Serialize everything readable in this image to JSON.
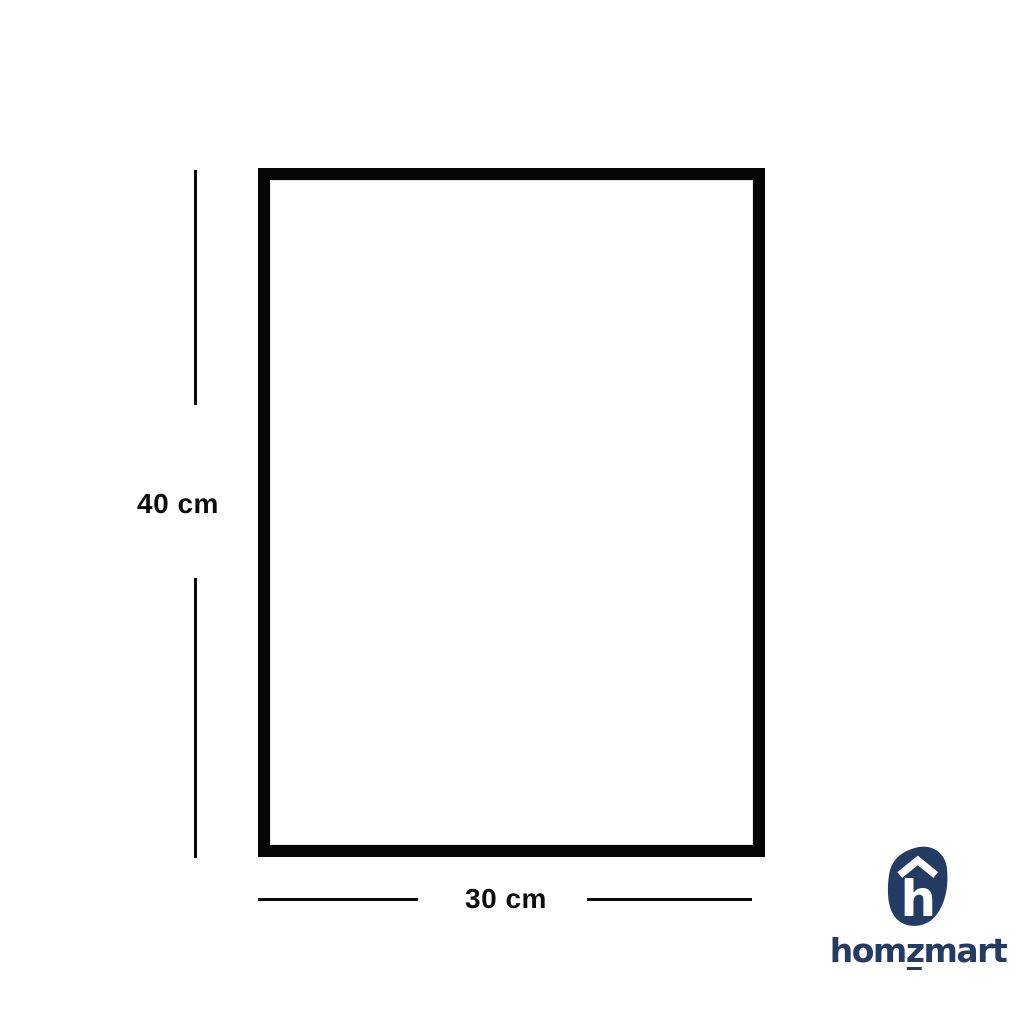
{
  "diagram": {
    "height_label": "40 cm",
    "width_label": "30 cm"
  },
  "logo": {
    "brand": "homzmart",
    "wordmark_pre": "hom",
    "wordmark_z": "z",
    "wordmark_post": "mart",
    "icon_letter": "h"
  },
  "colors": {
    "background": "#ffffff",
    "frame_border": "#060606",
    "dimension_lines": "#0a0a0a",
    "dimension_text": "#0c0c0c",
    "brand_navy": "#243b64"
  }
}
